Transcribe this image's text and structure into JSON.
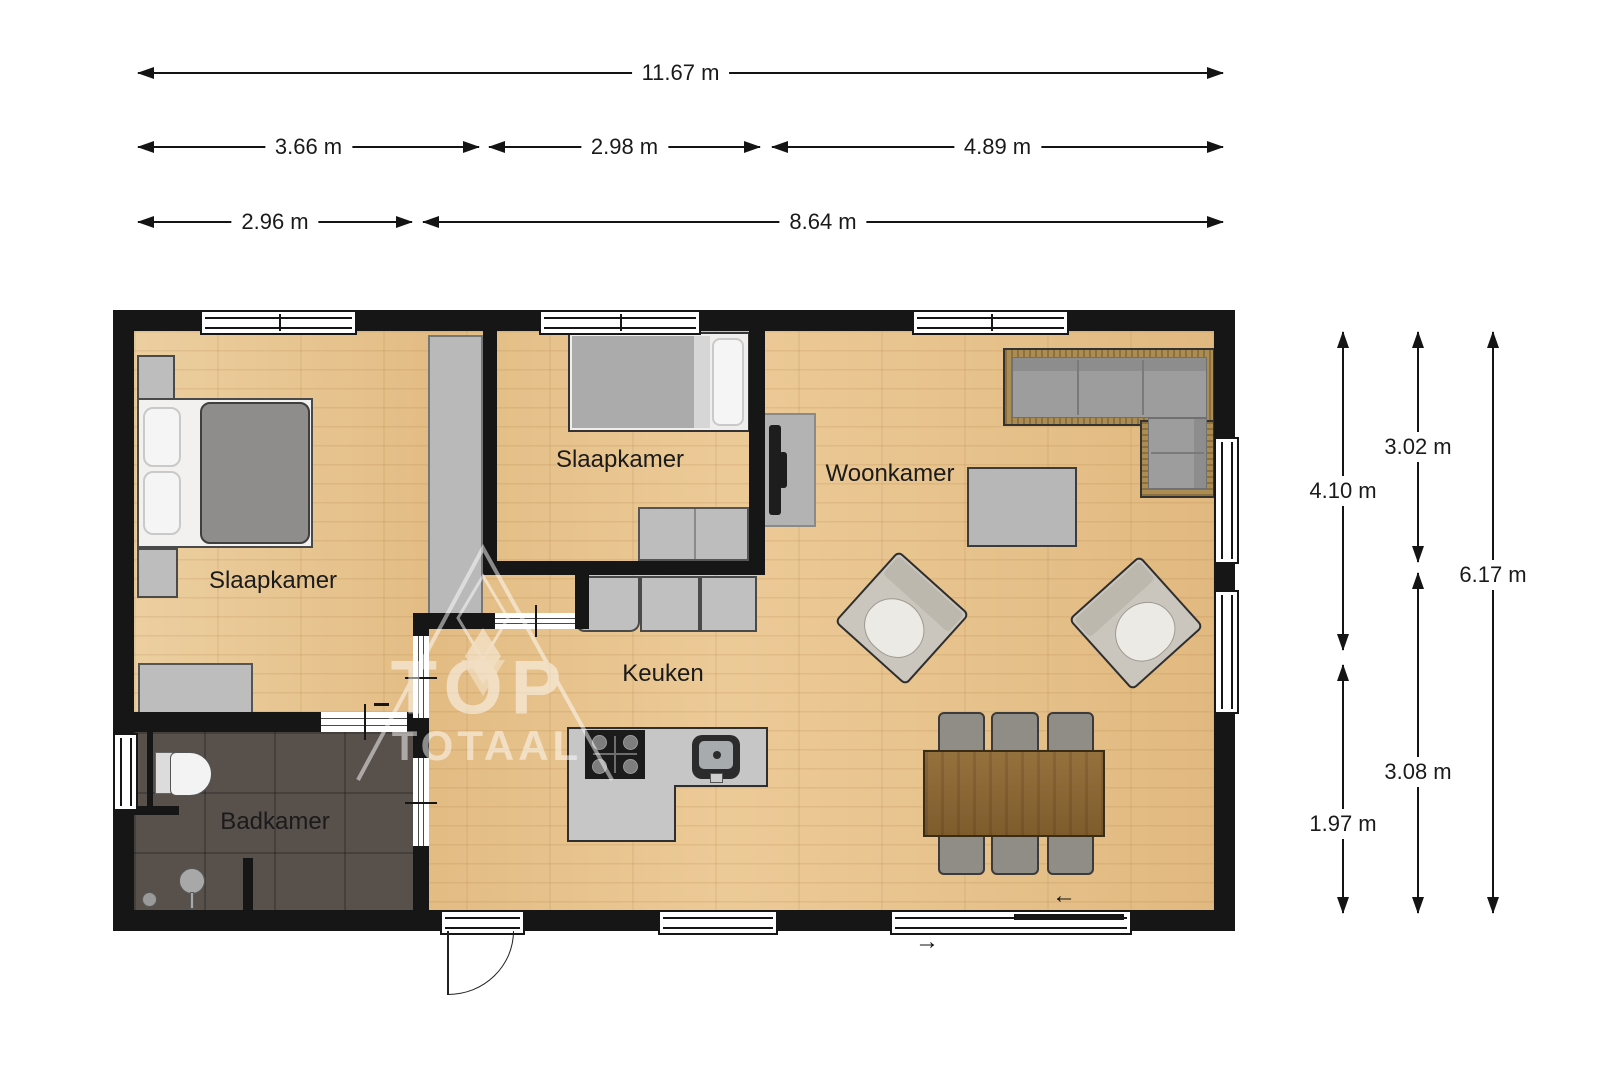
{
  "rooms": {
    "bedroom1": "Slaapkamer",
    "bedroom2": "Slaapkamer",
    "living": "Woonkamer",
    "kitchen": "Keuken",
    "bathroom": "Badkamer"
  },
  "dimensions": {
    "horizontal": {
      "total": "11.67 m",
      "row2": [
        "3.66 m",
        "2.98 m",
        "4.89 m"
      ],
      "row3": [
        "2.96 m",
        "8.64 m"
      ]
    },
    "vertical": {
      "col1": [
        "4.10 m",
        "1.97 m"
      ],
      "col2": [
        "3.02 m",
        "3.08 m"
      ],
      "total": "6.17 m"
    }
  },
  "watermark": {
    "line1": "TOP",
    "line2": "TOTAAL"
  },
  "entry_arrows": {
    "inside": "←",
    "outside": "→"
  },
  "colors": {
    "wall": "#161616",
    "wood_floor": "#e8c693",
    "bathroom_floor": "#57504b",
    "furniture_gray": "#bdbdbd",
    "sofa_wicker": "#ab8c52",
    "sofa_cushion": "#9d9d9d",
    "dining_table": "#8a6531",
    "text": "#1a1a1a"
  }
}
